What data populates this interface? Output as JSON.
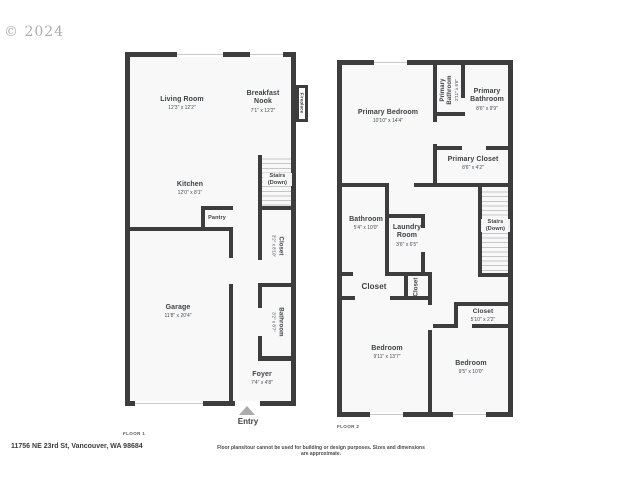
{
  "watermark": "© 2024",
  "footer": {
    "address": "11756 NE 23rd St, Vancouver, WA 98684",
    "disclaimer": "Floor plans/tour cannot be used for building or design purposes. Sizes and dimensions are approximate."
  },
  "floor1": {
    "label": "FLOOR 1",
    "entry_label": "Entry",
    "rooms": {
      "living": {
        "name": "Living Room",
        "dims": "12'3\" x 12'2\""
      },
      "breakfast": {
        "name": "Breakfast",
        "name2": "Nook",
        "dims": "7'1\" x 12'2\""
      },
      "fireplace": {
        "name": "Fireplace"
      },
      "kitchen": {
        "name": "Kitchen",
        "dims": "12'0\" x 8'1\""
      },
      "pantry": {
        "name": "Pantry"
      },
      "stairs": {
        "name": "Stairs",
        "name2": "(Down)"
      },
      "closet": {
        "name": "Closet",
        "dims": "3'2\" x 8'10\""
      },
      "bathroom": {
        "name": "Bathroom",
        "dims": "3'2\" x 8'7\""
      },
      "garage": {
        "name": "Garage",
        "dims": "11'8\" x 20'4\""
      },
      "foyer": {
        "name": "Foyer",
        "dims": "7'4\" x 4'8\""
      }
    }
  },
  "floor2": {
    "label": "FLOOR 2",
    "rooms": {
      "primary_bedroom": {
        "name": "Primary Bedroom",
        "dims": "10'10\" x 14'4\""
      },
      "primary_bathroom_small": {
        "name": "Primary",
        "name2": "Bathroom",
        "dims": "2'11\" x 6'6\""
      },
      "primary_bathroom": {
        "name": "Primary",
        "name2": "Bathroom",
        "dims": "8'6\" x 9'9\""
      },
      "primary_closet": {
        "name": "Primary Closet",
        "dims": "8'6\" x 4'2\""
      },
      "bathroom": {
        "name": "Bathroom",
        "dims": "5'4\" x 10'0\""
      },
      "laundry": {
        "name": "Laundry",
        "name2": "Room",
        "dims": "3'6\" x 6'5\""
      },
      "stairs": {
        "name": "Stairs",
        "name2": "(Down)"
      },
      "closet_hall": {
        "name": "Closet"
      },
      "closet_small": {
        "name": "Closet"
      },
      "closet_bedroom2": {
        "name": "Closet",
        "dims": "5'10\" x 2'2\""
      },
      "bedroom1": {
        "name": "Bedroom",
        "dims": "9'11\" x 13'7\""
      },
      "bedroom2": {
        "name": "Bedroom",
        "dims": "9'5\" x 10'0\""
      }
    }
  }
}
